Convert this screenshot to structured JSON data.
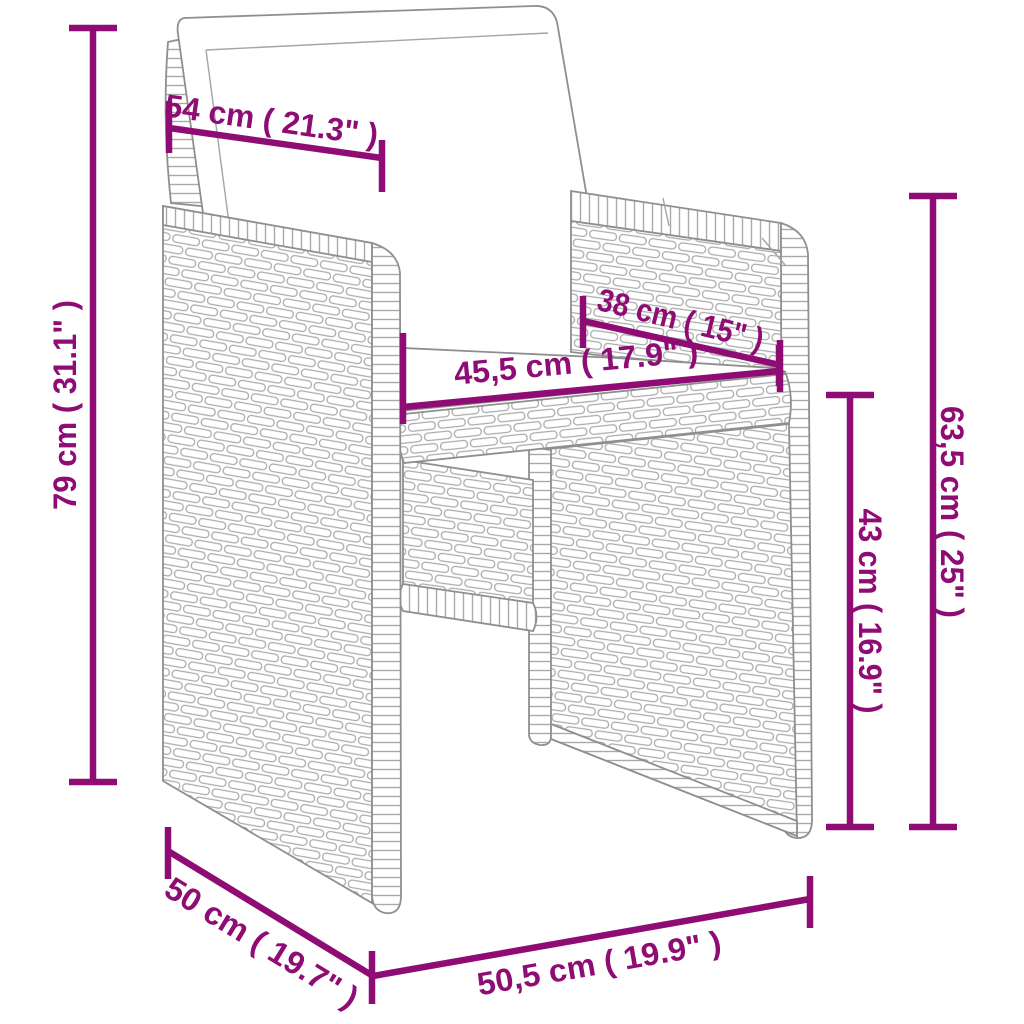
{
  "diagram": {
    "type": "product-dimension-diagram",
    "subject": "poly-rattan cube armchair with white back and seat cushions",
    "style": {
      "accent_color": "#8e0c74",
      "line_art_color": "#8f8f8f",
      "cushion_color": "#ffffff",
      "background": "#ffffff"
    },
    "dimensions": [
      {
        "name": "back-cushion-width",
        "label": "54 cm ( 21.3\" )",
        "value_cm": 54,
        "value_in": 21.3
      },
      {
        "name": "total-height",
        "label": "79 cm ( 31.1\" )",
        "value_cm": 79,
        "value_in": 31.1
      },
      {
        "name": "seat-depth",
        "label": "38 cm ( 15\" )",
        "value_cm": 38,
        "value_in": 15
      },
      {
        "name": "seat-width",
        "label": "45,5 cm ( 17.9\" )",
        "value_cm": 45.5,
        "value_in": 17.9
      },
      {
        "name": "armrest-height",
        "label": "63,5 cm ( 25\" )",
        "value_cm": 63.5,
        "value_in": 25
      },
      {
        "name": "seat-height",
        "label": "43 cm ( 16.9\" )",
        "value_cm": 43,
        "value_in": 16.9
      },
      {
        "name": "base-depth",
        "label": "50 cm ( 19.7\" )",
        "value_cm": 50,
        "value_in": 19.7
      },
      {
        "name": "base-width",
        "label": "50,5 cm ( 19.9\" )",
        "value_cm": 50.5,
        "value_in": 19.9
      }
    ]
  }
}
